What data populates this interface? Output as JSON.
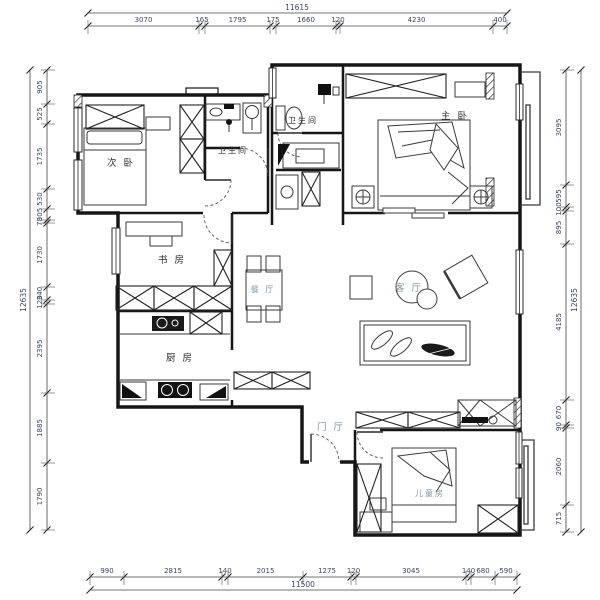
{
  "drawing": {
    "type": "apartment floor plan",
    "wall_color": "#161616",
    "dim_color": "#3a4663",
    "label_dark_color": "#2f2f2f",
    "label_light_color": "#7d98a8",
    "background": "#ffffff"
  },
  "rooms": [
    {
      "id": "secondary-bedroom",
      "label": "次 卧",
      "x": 121,
      "y": 166,
      "tone": "dark",
      "small": false
    },
    {
      "id": "bathroom-1",
      "label": "卫生间",
      "x": 233,
      "y": 153,
      "tone": "dark",
      "small": true
    },
    {
      "id": "bathroom-2",
      "label": "卫生间",
      "x": 303,
      "y": 123,
      "tone": "dark",
      "small": true
    },
    {
      "id": "master-bedroom",
      "label": "主 卧",
      "x": 455,
      "y": 119,
      "tone": "dark",
      "small": false
    },
    {
      "id": "study",
      "label": "书 房",
      "x": 172,
      "y": 263,
      "tone": "dark",
      "small": false
    },
    {
      "id": "dining-room",
      "label": "餐 厅",
      "x": 263,
      "y": 292,
      "tone": "light",
      "small": true
    },
    {
      "id": "living-room",
      "label": "客 厅",
      "x": 409,
      "y": 291,
      "tone": "light",
      "small": false
    },
    {
      "id": "kitchen",
      "label": "厨 房",
      "x": 180,
      "y": 361,
      "tone": "dark",
      "small": false
    },
    {
      "id": "foyer",
      "label": "门 厅",
      "x": 331,
      "y": 430,
      "tone": "light",
      "small": false
    },
    {
      "id": "kids-room",
      "label": "儿童房",
      "x": 430,
      "y": 496,
      "tone": "light",
      "small": true
    }
  ],
  "dimensions": {
    "top": {
      "total": "11615",
      "segments": [
        "3070",
        "165",
        "1795",
        "175",
        "1660",
        "120",
        "4230",
        "400"
      ]
    },
    "bottom": {
      "total": "11500",
      "segments": [
        "990",
        "2815",
        "140",
        "2015",
        "1275",
        "120",
        "3045",
        "140",
        "680",
        "590"
      ]
    },
    "left": {
      "total": "12635",
      "segments": [
        "905",
        "525",
        "1735",
        "530",
        "305",
        "70",
        "1730",
        "340",
        "120",
        "2395",
        "1885",
        "1790"
      ]
    },
    "right": {
      "total": "12635",
      "segments": [
        "3095",
        "595",
        "100",
        "895",
        "4185",
        "670",
        "90",
        "2060",
        "715"
      ]
    }
  }
}
